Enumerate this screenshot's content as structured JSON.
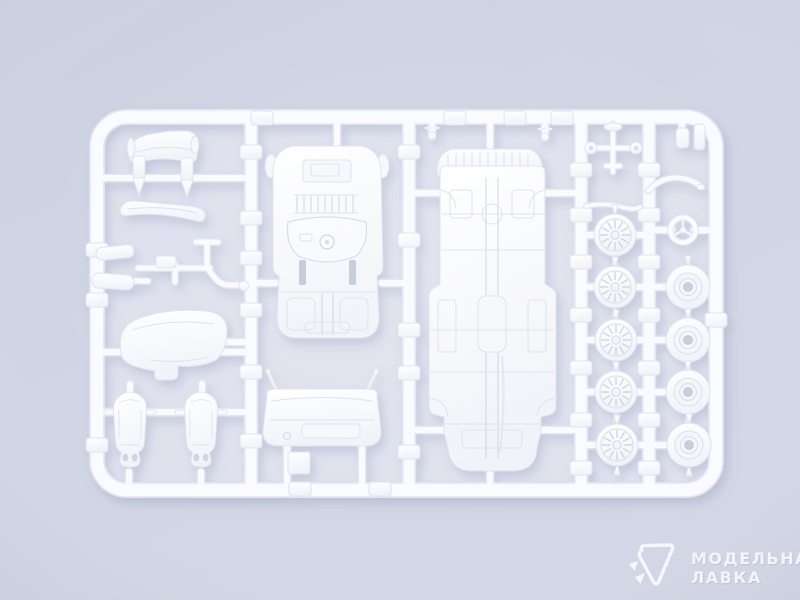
{
  "scene": {
    "subject": "White injection-molded plastic model-car parts sprue photographed on a pale lavender background",
    "background_color": "#d1d5e4",
    "plastic_color": "#fafbfe",
    "shadow_color": "#7d87ad"
  },
  "sprue_parts": [
    "curved roof panel",
    "shock absorber x2",
    "front bumper",
    "suspension linkage set",
    "rear cowl panel",
    "bucket seat x2",
    "interior tub with engine bay",
    "dashboard",
    "ribbed rear valance panel",
    "chassis floor pan",
    "front axle",
    "exhaust pipe",
    "steering wheel",
    "spoked wheel x5",
    "wheel hub x4"
  ],
  "watermark": {
    "logo_icon": "paper-plane-triangle",
    "line1": "МОДЕЛЬНАЯ",
    "line2": "ЛАВКА"
  }
}
